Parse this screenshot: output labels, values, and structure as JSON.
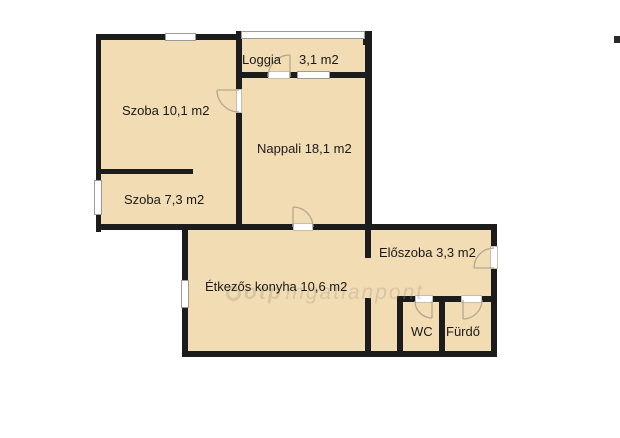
{
  "floorplan": {
    "rooms": {
      "szoba1": {
        "label": "Szoba 10,1 m2"
      },
      "szoba2": {
        "label": "Szoba 7,3 m2"
      },
      "loggia": {
        "label": "Loggia",
        "area": "3,1 m2"
      },
      "nappali": {
        "label": "Nappali 18,1 m2"
      },
      "eloszoba": {
        "label": "Előszoba 3,3 m2"
      },
      "konyha": {
        "label": "Étkezős konyha 10,6 m2"
      },
      "wc": {
        "label": "WC"
      },
      "furdo": {
        "label": "Fürdő"
      }
    },
    "watermark": {
      "brand": "otp",
      "name": "ingatlanpont"
    },
    "colors": {
      "room_fill": "#f2dcb3",
      "wall": "#1c1c1c",
      "background": "#ffffff",
      "window_frame": "#9b9b9b"
    }
  }
}
